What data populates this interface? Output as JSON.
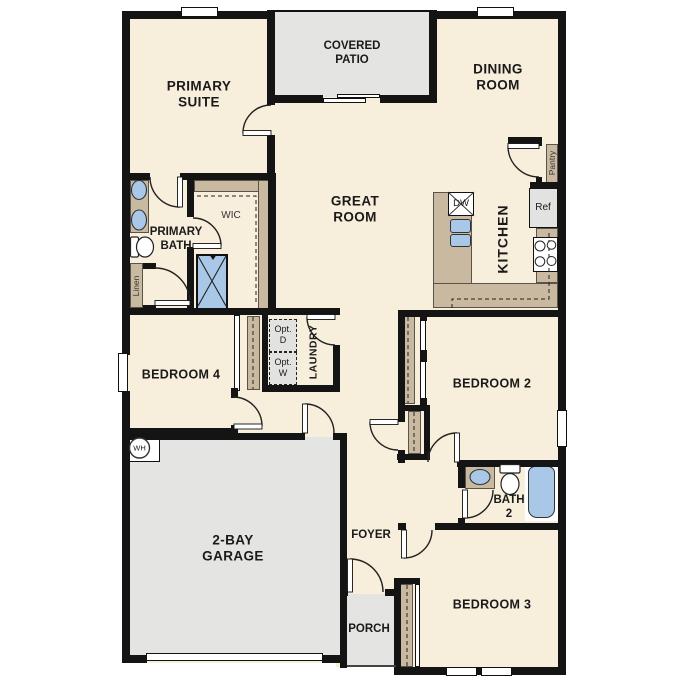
{
  "colors": {
    "floor": "#f7eedc",
    "wall": "#141414",
    "outdoor": "#e4e4e2",
    "counter": "#c9b9a1",
    "fixture": "#a9c8e8",
    "appliance": "#e2e2e0",
    "text": "#1a1a1a"
  },
  "rooms": {
    "covered_patio": {
      "line1": "COVERED",
      "line2": "PATIO"
    },
    "primary_suite": {
      "line1": "PRIMARY",
      "line2": "SUITE"
    },
    "dining_room": {
      "line1": "DINING",
      "line2": "ROOM"
    },
    "great_room": {
      "line1": "GREAT",
      "line2": "ROOM"
    },
    "kitchen": {
      "label": "KITCHEN"
    },
    "primary_bath": {
      "line1": "PRIMARY",
      "line2": "BATH"
    },
    "wic": {
      "label": "WIC"
    },
    "laundry": {
      "label": "LAUNDRY"
    },
    "bedroom4": {
      "label": "BEDROOM 4"
    },
    "bedroom2": {
      "label": "BEDROOM 2"
    },
    "bedroom3": {
      "label": "BEDROOM 3"
    },
    "bath2": {
      "line1": "BATH",
      "line2": "2"
    },
    "garage": {
      "line1": "2-BAY",
      "line2": "GARAGE"
    },
    "foyer": {
      "label": "FOYER"
    },
    "porch": {
      "label": "PORCH"
    }
  },
  "fixtures": {
    "pantry": "Pantry",
    "ref": "Ref",
    "dishwasher": "DW",
    "linen": "Linen",
    "opt_dryer": {
      "line1": "Opt.",
      "line2": "D"
    },
    "opt_washer": {
      "line1": "Opt.",
      "line2": "W"
    },
    "water_heater": "WH"
  }
}
